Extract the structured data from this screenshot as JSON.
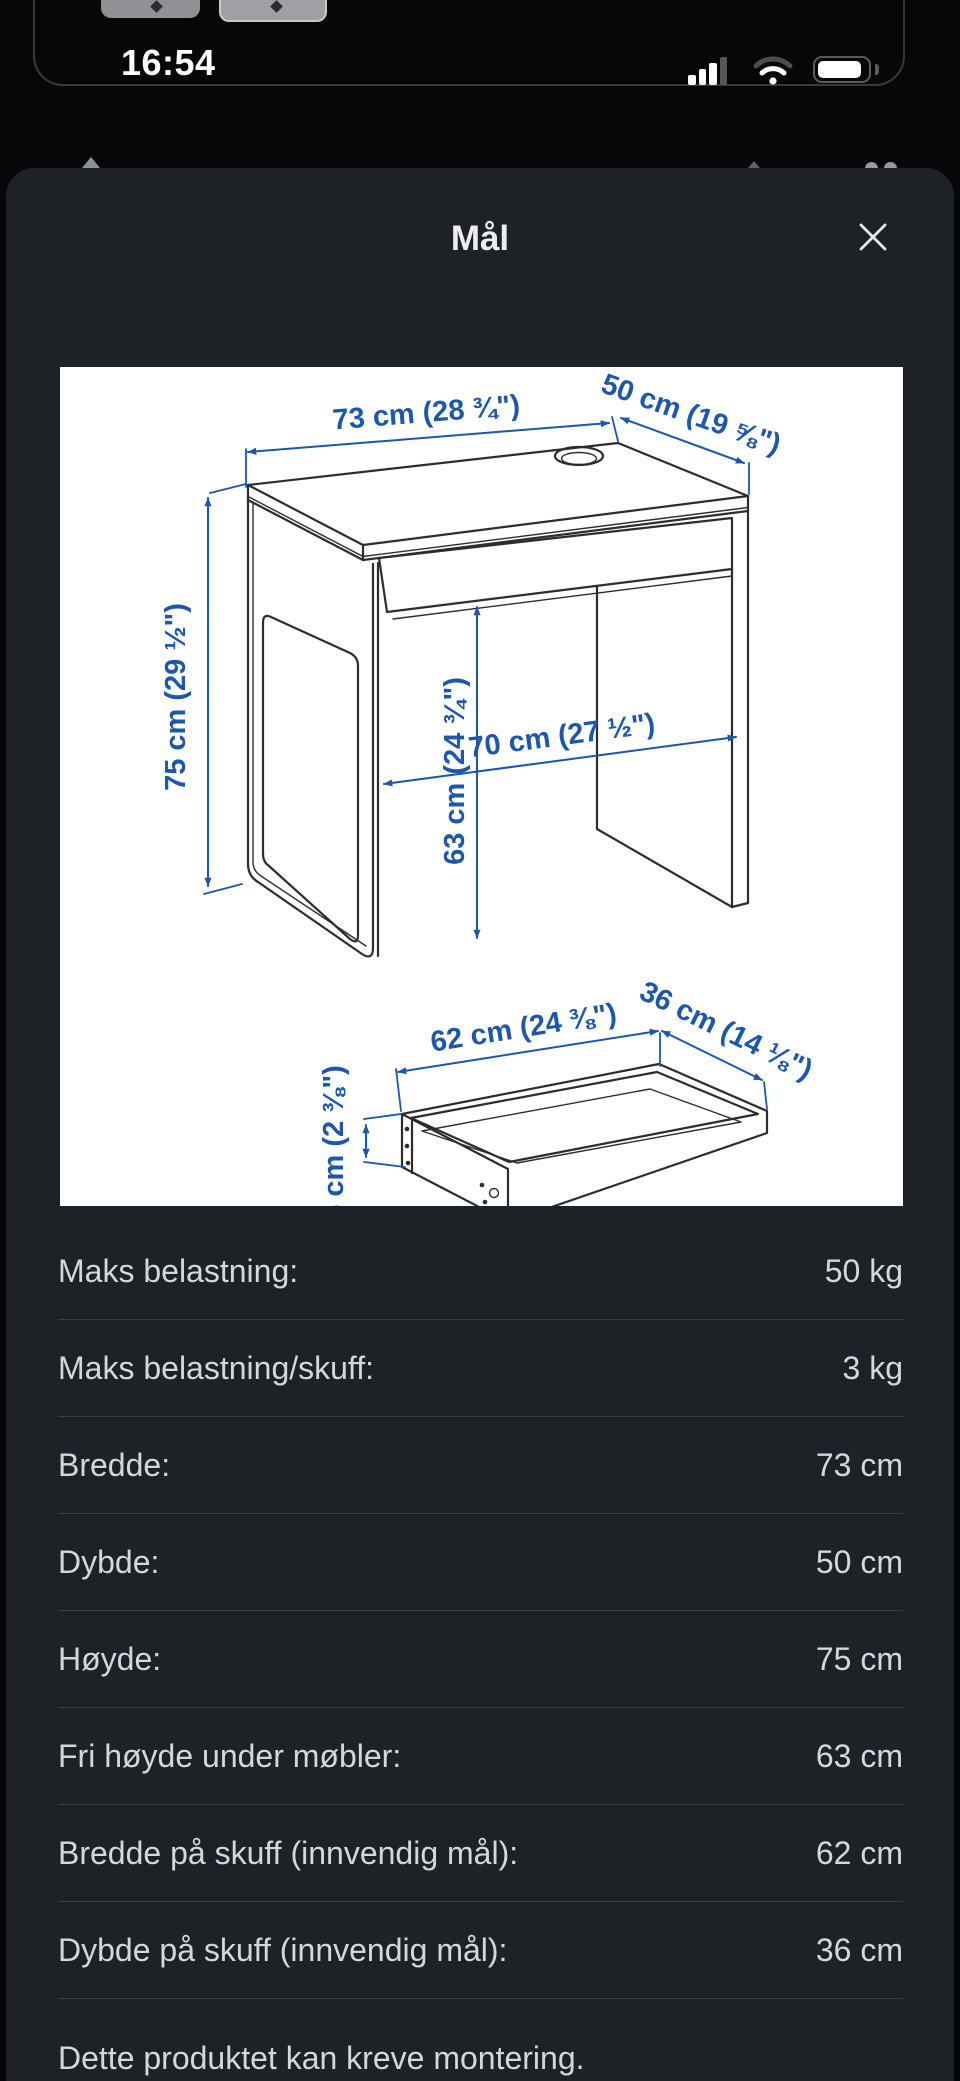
{
  "status_bar": {
    "time": "16:54"
  },
  "sheet": {
    "title": "Mål"
  },
  "diagram": {
    "accent_color": "#1c56ad",
    "line_color": "#2d2d2d",
    "labels": {
      "width": "73 cm (28 ¾\")",
      "depth": "50 cm (19 ⅝\")",
      "height": "75 cm (29 ½\")",
      "clearance_height": "63 cm (24 ¾\")",
      "clearance_width": "70 cm (27 ½\")",
      "drawer_width": "62 cm (24 ⅜\")",
      "drawer_depth": "36 cm (14 ⅛\")",
      "drawer_height": "6 cm (2 ⅜\")"
    }
  },
  "specs": {
    "rows": [
      {
        "label": "Maks belastning:",
        "value": "50 kg"
      },
      {
        "label": "Maks belastning/skuff:",
        "value": "3 kg"
      },
      {
        "label": "Bredde:",
        "value": "73 cm"
      },
      {
        "label": "Dybde:",
        "value": "50 cm"
      },
      {
        "label": "Høyde:",
        "value": "75 cm"
      },
      {
        "label": "Fri høyde under møbler:",
        "value": "63 cm"
      },
      {
        "label": "Bredde på skuff (innvendig mål):",
        "value": "62 cm"
      },
      {
        "label": "Dybde på skuff (innvendig mål):",
        "value": "36 cm"
      }
    ]
  },
  "footer": {
    "note": "Dette produktet kan kreve montering."
  }
}
